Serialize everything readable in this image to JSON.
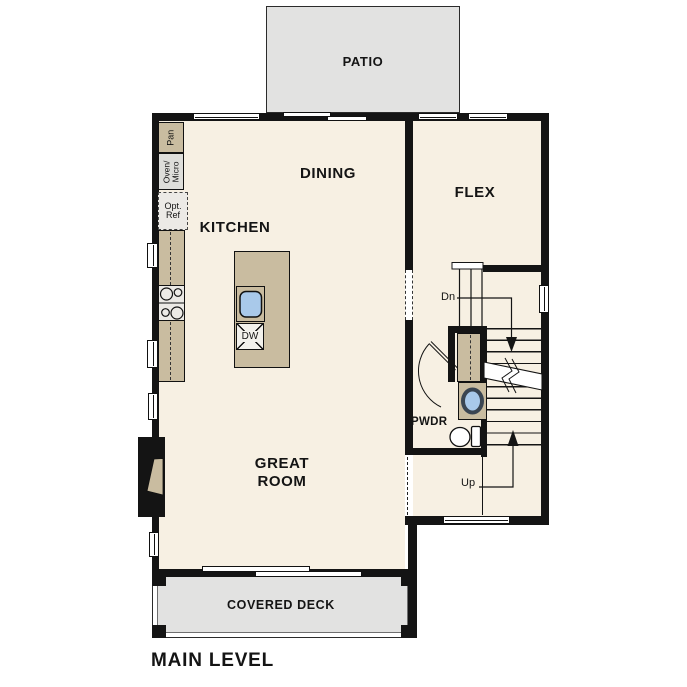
{
  "plan": {
    "title": "MAIN LEVEL",
    "rooms": {
      "patio": {
        "label": "PATIO"
      },
      "dining": {
        "label": "DINING"
      },
      "flex": {
        "label": "FLEX"
      },
      "kitchen": {
        "label": "KITCHEN"
      },
      "great_room": {
        "label": "GREAT\nROOM"
      },
      "powder": {
        "label": "PWDR"
      },
      "covered_deck": {
        "label": "COVERED DECK"
      }
    },
    "fixtures": {
      "pantry": {
        "label": "Pan"
      },
      "oven_micro": {
        "label": "Oven/\nMicro"
      },
      "opt_ref": {
        "label": "Opt.\nRef"
      },
      "dishwasher": {
        "label": "DW"
      }
    },
    "stairs": {
      "down": {
        "label": "Dn"
      },
      "up": {
        "label": "Up"
      }
    },
    "colors": {
      "floor": "#f7f0e3",
      "outdoor": "#e2e2e1",
      "wall": "#141414",
      "counter": "#c9bca0",
      "appliance": "#dededa",
      "sink_blue": "#a9c9ea"
    }
  }
}
